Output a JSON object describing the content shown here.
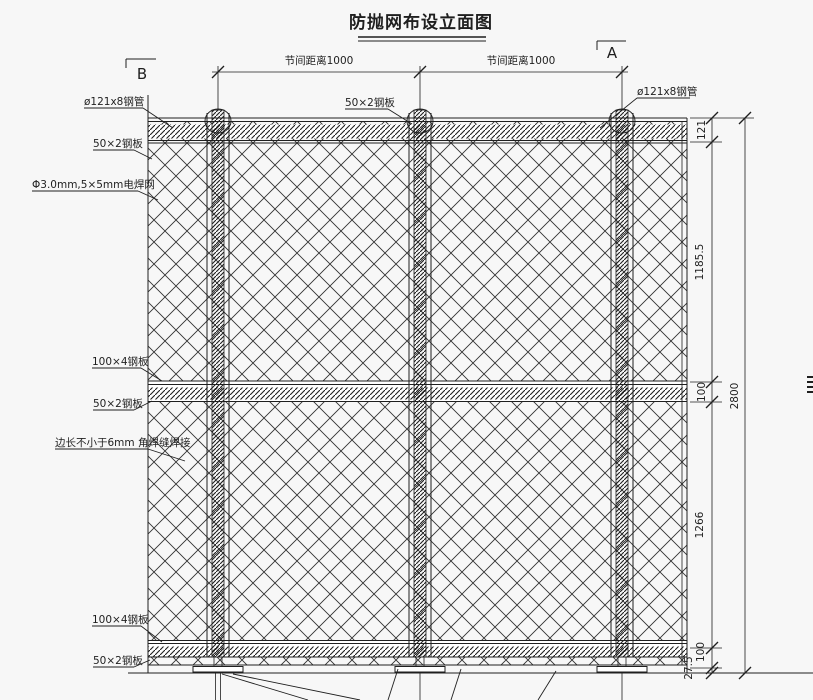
{
  "page": {
    "title": "防抛网布设立面图"
  },
  "section_markers": {
    "left": "B",
    "right": "A"
  },
  "top_dimensions": {
    "bay1": "节间距离1000",
    "bay2": "节间距离1000"
  },
  "callouts": {
    "top_left_pipe": "ø121x8钢管",
    "top_left_plate": "50×2钢板",
    "left_mesh": "Φ3.0mm,5×5mm电焊网",
    "mid_left_plate100": "100×4钢板",
    "mid_left_plate50": "50×2钢板",
    "left_weld": "边长不小于6mm 角焊缝焊接",
    "bottom_left_plate100": "100×4钢板",
    "bottom_left_plate50": "50×2钢板",
    "top_center_plate": "50×2钢板",
    "top_right_pipe": "ø121x8钢管"
  },
  "right_dimensions": {
    "pipe": "121",
    "upper_panel": "1185.5",
    "mid_rail": "100",
    "lower_panel": "1266",
    "bottom_rail": "100",
    "base": "27.5",
    "overall": "2800"
  },
  "colors": {
    "ink": "#1f1f1f",
    "background": "#f7f7f7"
  }
}
